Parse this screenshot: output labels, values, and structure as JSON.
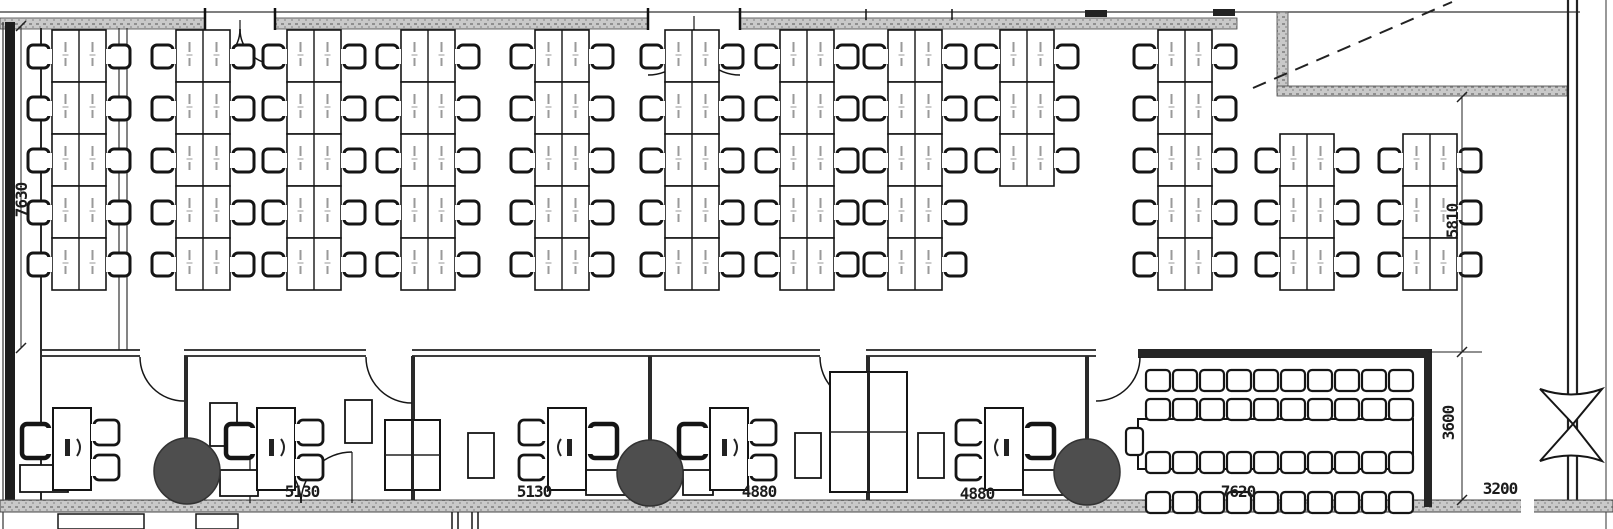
{
  "title": "office-floor-plan",
  "dimensions": {
    "left_depth": "7630",
    "right_depth": "5810",
    "office_1_width": "5130",
    "office_2_width": "5130",
    "office_3_width": "4880",
    "office_4_width": "4880",
    "conference_width": "7620",
    "right_room_depth": "3600",
    "right_strip_width": "3200"
  },
  "open_area": {
    "desk_islands": [
      {
        "x": 52,
        "rows": [
          1,
          2,
          3,
          4,
          5
        ]
      },
      {
        "x": 176,
        "rows": [
          1,
          2,
          3,
          4,
          5
        ]
      },
      {
        "x": 287,
        "rows": [
          1,
          2,
          3,
          4,
          5
        ]
      },
      {
        "x": 401,
        "rows": [
          1,
          2,
          3,
          4,
          5
        ]
      },
      {
        "x": 535,
        "rows": [
          1,
          2,
          3,
          4,
          5
        ]
      },
      {
        "x": 665,
        "rows": [
          1,
          2,
          3,
          4,
          5
        ]
      },
      {
        "x": 780,
        "rows": [
          1,
          2,
          3,
          4,
          5
        ]
      },
      {
        "x": 888,
        "rows": [
          1,
          2,
          3,
          4,
          5
        ]
      },
      {
        "x": 1000,
        "rows": [
          1,
          2,
          3
        ]
      },
      {
        "x": 1158,
        "rows": [
          1,
          2,
          3,
          4,
          5
        ]
      },
      {
        "x": 1280,
        "rows": [
          3,
          4,
          5
        ]
      },
      {
        "x": 1403,
        "rows": [
          3,
          4,
          5
        ]
      }
    ]
  },
  "private_offices": {
    "desks": [
      {
        "x": 53,
        "mirror": false
      },
      {
        "x": 257,
        "mirror": false
      },
      {
        "x": 548,
        "mirror": true
      },
      {
        "x": 710,
        "mirror": false
      },
      {
        "x": 985,
        "mirror": true
      }
    ],
    "round_tables": [
      {
        "cx": 187,
        "cy": 471
      },
      {
        "cx": 650,
        "cy": 473
      },
      {
        "cx": 1087,
        "cy": 472
      }
    ],
    "cabinets": [
      [
        210,
        403,
        27,
        43
      ],
      [
        345,
        400,
        27,
        43
      ],
      [
        468,
        433,
        26,
        45
      ],
      [
        795,
        433,
        26,
        45
      ],
      [
        918,
        433,
        26,
        45
      ]
    ],
    "desk_returns": [
      [
        20,
        465,
        48,
        27
      ],
      [
        220,
        470,
        38,
        26
      ],
      [
        586,
        470,
        64,
        25
      ],
      [
        683,
        470,
        30,
        25
      ],
      [
        1023,
        470,
        62,
        25
      ]
    ],
    "partition_tables": [
      [
        385,
        420,
        55,
        70
      ],
      [
        830,
        372,
        77,
        120
      ]
    ]
  },
  "conference_room": {
    "chairs_per_row": 10,
    "row_y": [
      370,
      399,
      452,
      492
    ],
    "start_x": 1146,
    "step": 27,
    "table": [
      1138,
      419,
      275,
      50
    ],
    "end_chair": [
      1126,
      428
    ]
  }
}
